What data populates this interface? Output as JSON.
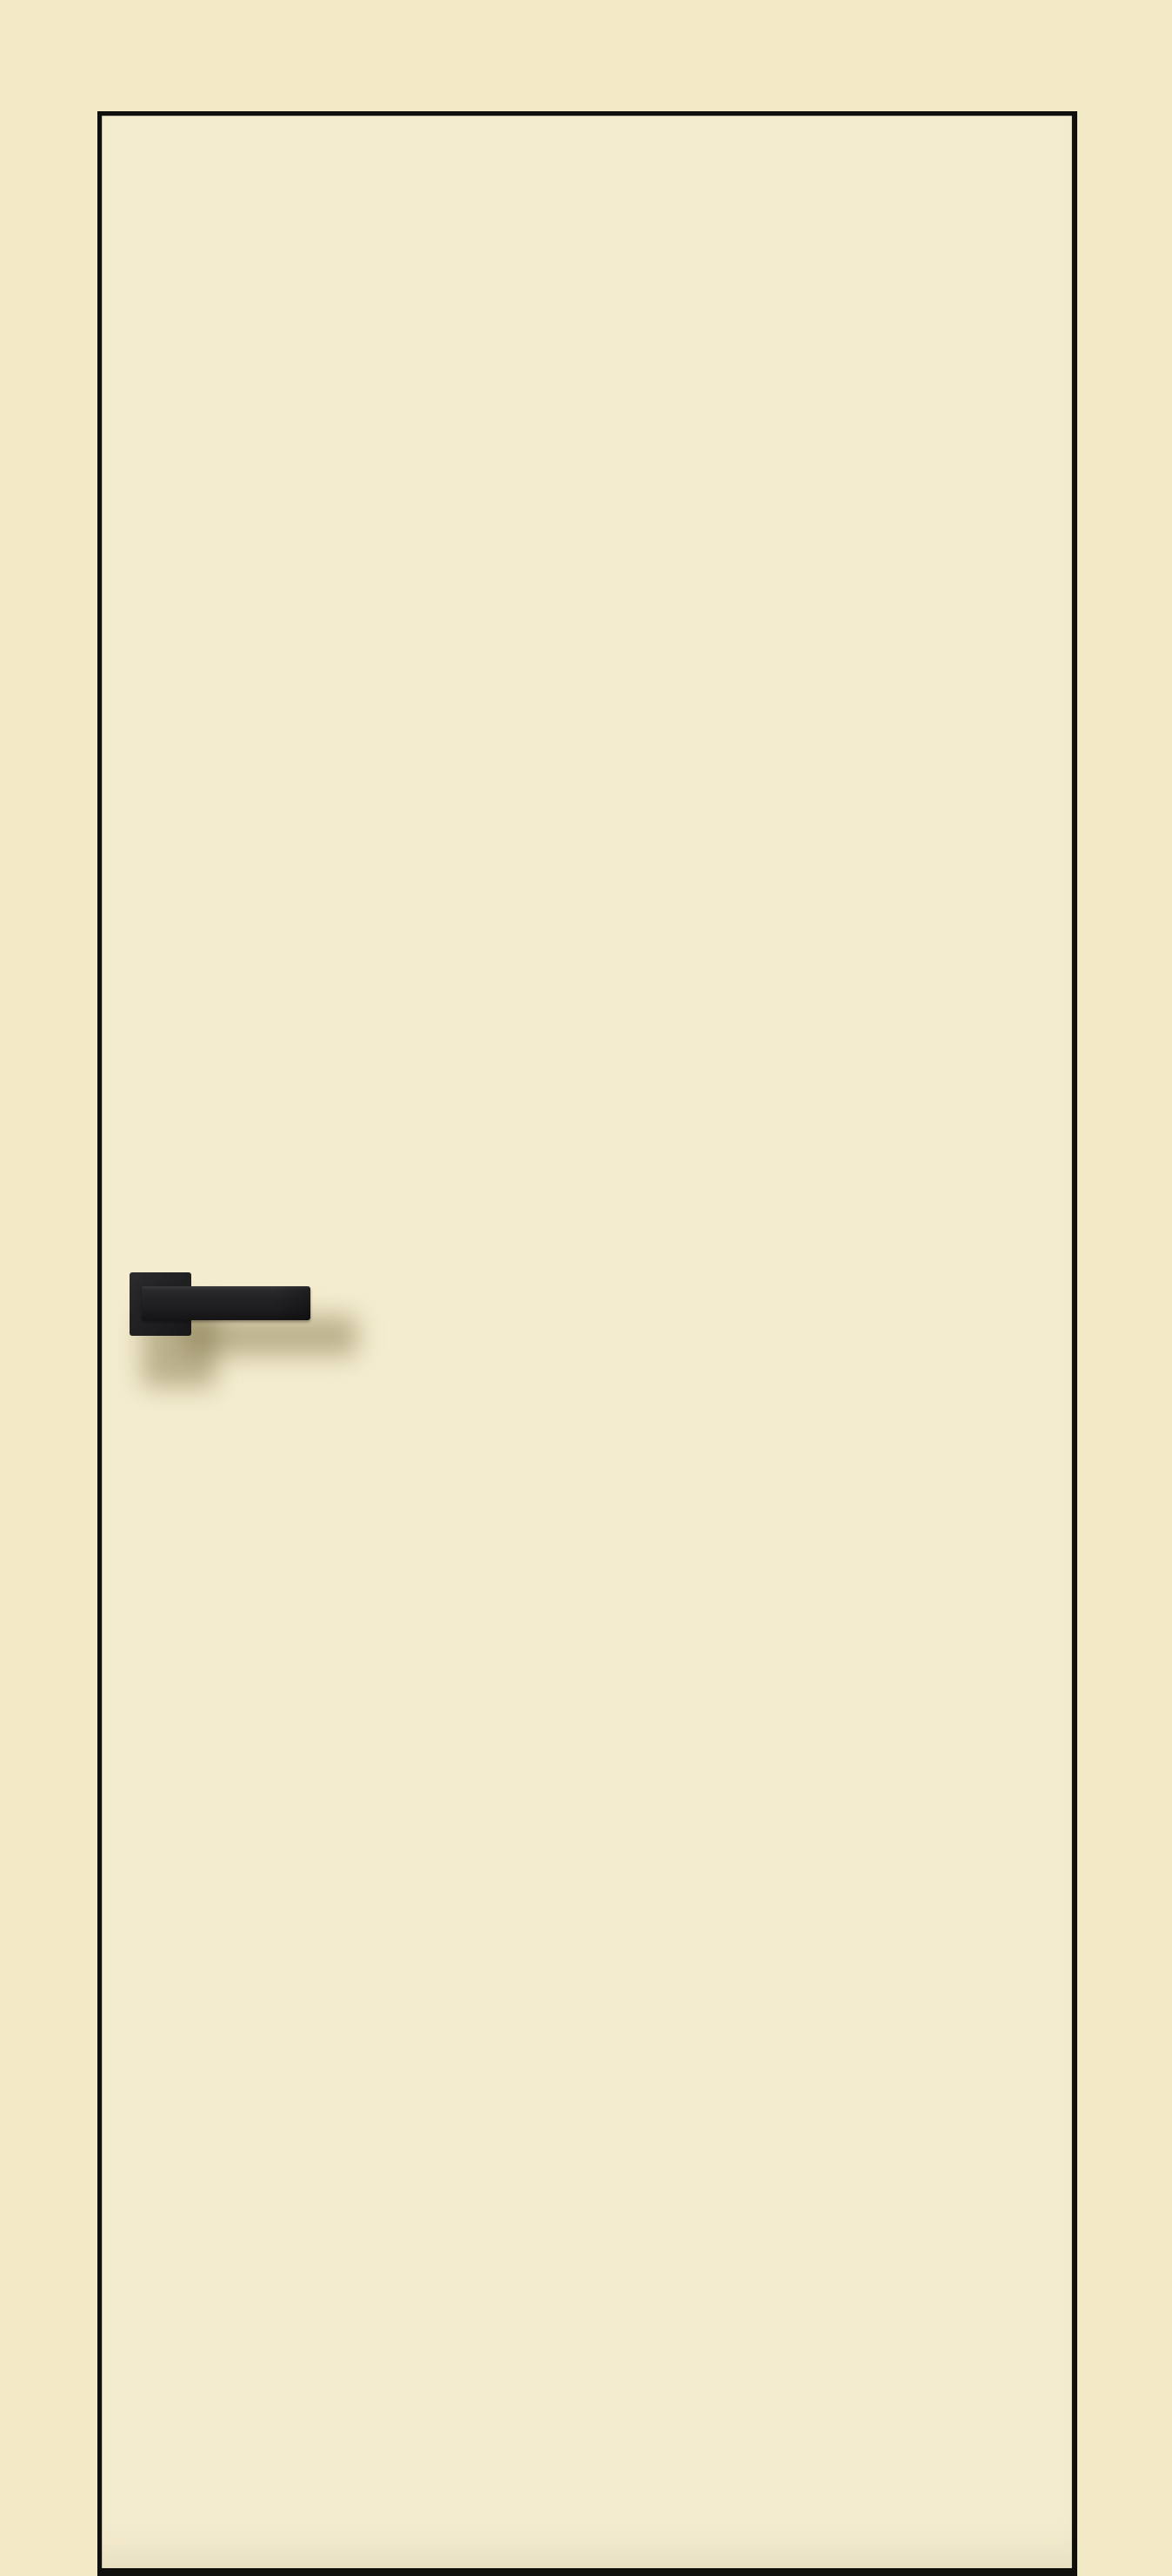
{
  "scene": {
    "type": "product-photo",
    "subject": "flush interior door leaf, cream finish, black thin frame outline, black square-rosette lever handle on left side at mid height",
    "visible_text": "",
    "objects": [
      {
        "name": "photo-background",
        "label": "plain cream backdrop"
      },
      {
        "name": "door-panel",
        "label": "cream flush door with thin black edge outline"
      },
      {
        "name": "handle-rosette",
        "label": "black square handle rosette plate"
      },
      {
        "name": "handle-lever",
        "label": "black rectangular lever handle pointing right"
      },
      {
        "name": "handle-shadow",
        "label": "soft shadow cast by handle onto door"
      }
    ]
  },
  "colors": {
    "background": "#f2e9c6",
    "door_fill": "#f4ecce",
    "door_border": "#0f0f0d",
    "handle_dark": "#1d1d1f",
    "handle_mid": "#232325",
    "handle_highlight": "#39393c",
    "shadow_color": "rgba(118,106,62,0.45)"
  }
}
